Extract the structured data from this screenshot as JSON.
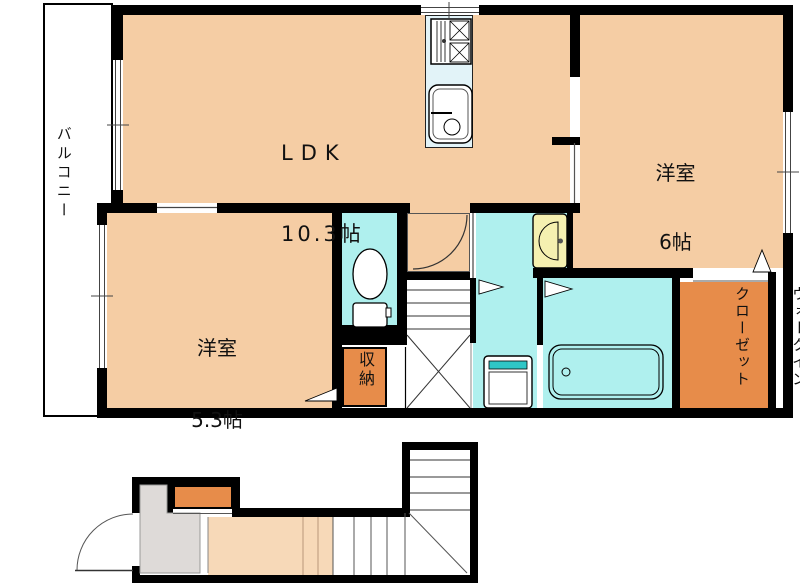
{
  "floor_plan": {
    "upper_floor": {
      "balcony_label": "バルコニー",
      "ldk": {
        "name": "LDK",
        "size": "10.3帖"
      },
      "bedroom_6": {
        "name": "洋室",
        "size": "6帖"
      },
      "bedroom_53": {
        "name": "洋室",
        "size": "5.3帖"
      },
      "storage_label": "収納",
      "walk_in_closet": {
        "line1": "ウォークイン",
        "line2": "クローゼット"
      }
    },
    "colors": {
      "room_floor": "#F5CDA4",
      "wet_area": "#AFF0EE",
      "kitchen_counter": "#E2F3F8",
      "closet_orange": "#E78C4A",
      "entrance_gray": "#DEDAD8",
      "basin_yellow": "#F5F0B0",
      "washer_teal": "#2FC6C6",
      "wall": "#000000",
      "hall_floor": "#F7D9B8"
    },
    "fixtures": [
      "gas-stove",
      "kitchen-sink",
      "toilet",
      "washbasin",
      "washing-machine",
      "bathtub",
      "stairs-upper",
      "stairs-lower",
      "entrance-door",
      "interior-door"
    ]
  }
}
